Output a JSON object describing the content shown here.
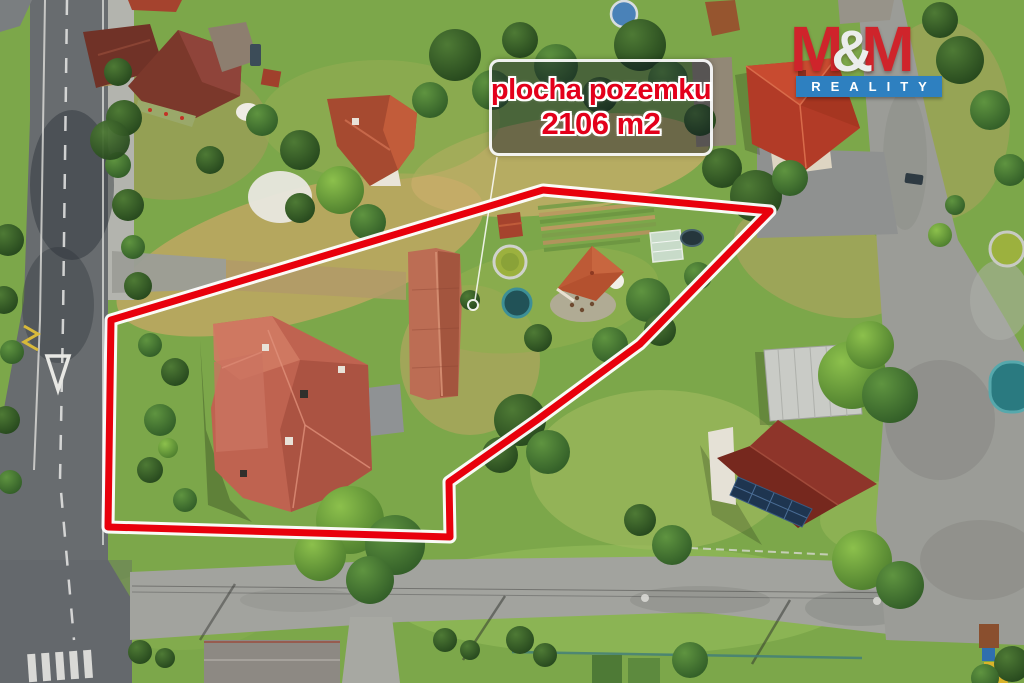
{
  "annotation": {
    "line1": "plocha pozemku",
    "line2": "2106 m2"
  },
  "logo": {
    "m1": "M",
    "amp": "&",
    "m2": "M",
    "subtitle": "REALITY"
  },
  "colors": {
    "boundary-red": "#e8000c",
    "boundary-casing": "#ffffff",
    "label-text": "#e3001b",
    "label-border": "#f5f5f5",
    "logo-red": "#cf242b",
    "logo-amp": "#ebedec",
    "logo-blue": "#2e80c0",
    "logo-subtitle-text": "#ffffff"
  }
}
